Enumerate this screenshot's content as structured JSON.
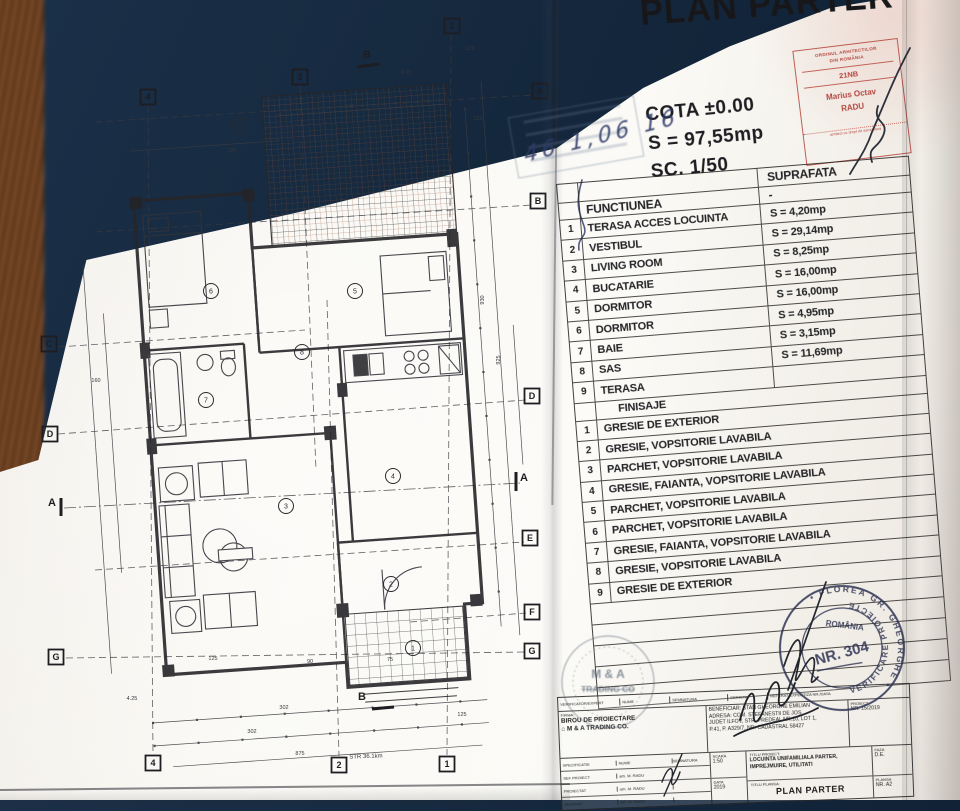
{
  "colors": {
    "background_navy": "#14273c",
    "fabric_brown": "#6e4526",
    "paper": "#f9f7f2",
    "ink": "#232326",
    "red_stamp": "#ac302a",
    "pen_blue": "#2e3a68",
    "stamp_blue": "#2b3050"
  },
  "header": {
    "title": "PLAN PARTER",
    "cota": "COTA ±0.00",
    "surface": "S = 97,55mp",
    "scale": "SC. 1/50"
  },
  "architect_stamp": {
    "org_line1": "ORDINUL ARHITECTILOR",
    "org_line2": "DIN ROMÂNIA",
    "number": "21NB",
    "name_line1": "Marius Octav",
    "name_line2": "RADU",
    "footer": "arhitect cu drept de semnatura"
  },
  "handwritten_date": "46 1,06 16",
  "functiuni_table": {
    "col_functiunea": "FUNCTIUNEA",
    "col_suprafata": "SUPRAFATA",
    "dash": "-",
    "rows": [
      {
        "nr": "1",
        "label": "TERASA ACCES LOCUINTA",
        "value": "S = 4,20mp"
      },
      {
        "nr": "2",
        "label": "VESTIBUL",
        "value": "S = 29,14mp"
      },
      {
        "nr": "3",
        "label": "LIVING ROOM",
        "value": "S = 8,25mp"
      },
      {
        "nr": "4",
        "label": "BUCATARIE",
        "value": "S = 16,00mp"
      },
      {
        "nr": "5",
        "label": "DORMITOR",
        "value": "S = 16,00mp"
      },
      {
        "nr": "6",
        "label": "DORMITOR",
        "value": "S = 4,95mp"
      },
      {
        "nr": "7",
        "label": "BAIE",
        "value": "S = 3,15mp"
      },
      {
        "nr": "8",
        "label": "SAS",
        "value": "S = 11,69mp"
      },
      {
        "nr": "9",
        "label": "TERASA",
        "value": ""
      }
    ]
  },
  "finisaje_table": {
    "title": "FINISAJE",
    "rows": [
      {
        "nr": "1",
        "label": "GRESIE DE EXTERIOR"
      },
      {
        "nr": "2",
        "label": "GRESIE, VOPSITORIE LAVABILA"
      },
      {
        "nr": "3",
        "label": "PARCHET, VOPSITORIE LAVABILA"
      },
      {
        "nr": "4",
        "label": "GRESIE, FAIANTA, VOPSITORIE LAVABILA"
      },
      {
        "nr": "5",
        "label": "PARCHET, VOPSITORIE LAVABILA"
      },
      {
        "nr": "6",
        "label": "PARCHET, VOPSITORIE LAVABILA"
      },
      {
        "nr": "7",
        "label": "GRESIE, FAIANTA, VOPSITORIE LAVABILA"
      },
      {
        "nr": "8",
        "label": "GRESIE, VOPSITORIE LAVABILA"
      },
      {
        "nr": "9",
        "label": "GRESIE DE EXTERIOR"
      }
    ]
  },
  "verifier_stamp": {
    "arc_top": "• FLOREA GR. GHEORGHE •",
    "arc_bottom": "VERIFICARE PROIECTE",
    "center_line1": "ROMÂNIA",
    "center_line2": "NR. 304"
  },
  "company_stamp": {
    "line1": "M & A",
    "line2": "TRADING CO"
  },
  "cartouche": {
    "verif_row": {
      "c1": "VERIFICATOR/EXPERT",
      "c2": "NUME",
      "c3": "SEMNATURA",
      "c4": "CERINTA",
      "c5": "REFERAT/EXPERTIZA NR./DATA"
    },
    "firm": {
      "label": "FIRMA:",
      "line1": "BIROU DE PROIECTARE",
      "line2": "M & A TRADING CO.",
      "house_icon": "⌂"
    },
    "client": {
      "line1": "BENEFICIAR: STAN GHEORGHE EMILIAN",
      "line2": "ADRESA: COM. STEFANESTII DE JOS,",
      "line3": "JUDET ILFOV, STR. PREDEAL NR.10, LOT 1,",
      "line4": "P.41, P. A329/7, NR. CADASTRAL 58427"
    },
    "project_no": {
      "label": "PROIECT",
      "value": "NR. 15/2019"
    },
    "spec_header": {
      "c1": "SPECIFICATIE",
      "c2": "NUME",
      "c3": "SEMNATURA"
    },
    "spec_rows": [
      {
        "label": "SEF PROIECT",
        "name": "arh. M. RADU"
      },
      {
        "label": "PROIECTAT",
        "name": "arh. M. RADU"
      },
      {
        "label": "DESENAT",
        "name": "arh. M. RADU"
      }
    ],
    "scara": {
      "label": "SCARA",
      "value": "1:50"
    },
    "data": {
      "label": "DATA",
      "value": "2019"
    },
    "titlu_proiect": {
      "label": "TITLU PROIECT:",
      "line1": "LOCUINTA UNIFAMILIALA PARTER,",
      "line2": "IMPREJMUIRE, UTILITATI"
    },
    "titlu_plansa": {
      "label": "TITLU PLANSA:",
      "value": "PLAN PARTER"
    },
    "faza": {
      "label": "FAZA",
      "value": "D.E."
    },
    "plansa_no": {
      "label": "PLANSA",
      "value": "NR. A2"
    }
  },
  "plan": {
    "axis_markers": [
      {
        "label": "4",
        "x": 148,
        "y": 97
      },
      {
        "label": "3",
        "x": 300,
        "y": 77
      },
      {
        "label": "1",
        "x": 452,
        "y": 26
      },
      {
        "label": "A",
        "x": 540,
        "y": 91
      },
      {
        "label": "B",
        "x": 538,
        "y": 201
      },
      {
        "label": "D",
        "x": 532,
        "y": 396
      },
      {
        "label": "E",
        "x": 530,
        "y": 538
      },
      {
        "label": "F",
        "x": 532,
        "y": 612
      },
      {
        "label": "G",
        "x": 532,
        "y": 651
      },
      {
        "label": "C",
        "x": 49,
        "y": 344
      },
      {
        "label": "D",
        "x": 50,
        "y": 434
      },
      {
        "label": "G",
        "x": 56,
        "y": 657
      },
      {
        "label": "4",
        "x": 153,
        "y": 763
      },
      {
        "label": "2",
        "x": 339,
        "y": 765
      },
      {
        "label": "1",
        "x": 447,
        "y": 764
      }
    ],
    "section_labels": [
      {
        "label": "B",
        "x": 367,
        "y": 58
      },
      {
        "label": "B",
        "x": 362,
        "y": 700
      },
      {
        "label": "A",
        "x": 52,
        "y": 506
      },
      {
        "label": "A",
        "x": 524,
        "y": 481
      }
    ],
    "room_circles": [
      {
        "nr": "9",
        "x": 240,
        "y": 125
      },
      {
        "nr": "6",
        "x": 211,
        "y": 291
      },
      {
        "nr": "5",
        "x": 355,
        "y": 291
      },
      {
        "nr": "7",
        "x": 206,
        "y": 400
      },
      {
        "nr": "8",
        "x": 302,
        "y": 352
      },
      {
        "nr": "4",
        "x": 393,
        "y": 476
      },
      {
        "nr": "3",
        "x": 286,
        "y": 506
      },
      {
        "nr": "2",
        "x": 391,
        "y": 584
      },
      {
        "nr": "1",
        "x": 413,
        "y": 648
      }
    ],
    "dim_labels": [
      {
        "t": "123",
        "x": 470,
        "y": 50
      },
      {
        "t": "4.05",
        "x": 406,
        "y": 74
      },
      {
        "t": "125",
        "x": 478,
        "y": 120
      },
      {
        "t": "285",
        "x": 232,
        "y": 152
      },
      {
        "t": "142",
        "x": 350,
        "y": 108
      },
      {
        "t": "160",
        "x": 96,
        "y": 382
      },
      {
        "t": "930",
        "x": 484,
        "y": 300,
        "rot": -90
      },
      {
        "t": "925",
        "x": 500,
        "y": 360,
        "rot": -90
      },
      {
        "t": "125",
        "x": 213,
        "y": 660
      },
      {
        "t": "90",
        "x": 310,
        "y": 663
      },
      {
        "t": "75",
        "x": 390,
        "y": 661
      },
      {
        "t": "302",
        "x": 284,
        "y": 709
      },
      {
        "t": "302",
        "x": 252,
        "y": 733
      },
      {
        "t": "125",
        "x": 462,
        "y": 716
      },
      {
        "t": "4.25",
        "x": 132,
        "y": 700
      },
      {
        "t": "875",
        "x": 300,
        "y": 755
      }
    ],
    "street_label": "STR 36.1km"
  }
}
